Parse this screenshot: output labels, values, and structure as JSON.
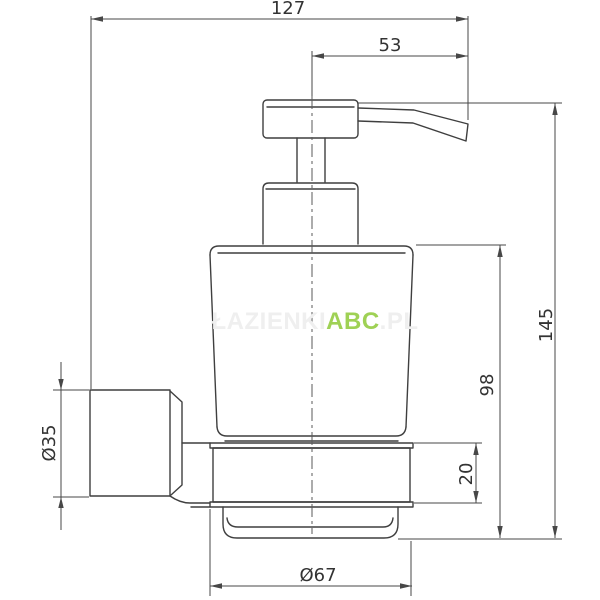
{
  "drawing": {
    "title": "Wall-mounted soap dispenser — dimensional drawing"
  },
  "dimensions": {
    "total_reach": "127",
    "spout_reach": "53",
    "total_height": "145",
    "bottle_height": "98",
    "holder_ring_height": "20",
    "bracket_diameter": "Ø35",
    "holder_ring_diameter": "Ø67"
  },
  "watermark": {
    "prefix": "ŁAZIENKI",
    "brand": "ABC",
    "suffix": ".PL"
  },
  "colors": {
    "outline": "#3f3f3f",
    "dimension": "#474747",
    "text": "#333333",
    "watermark_brand": "#9fd155",
    "watermark_faint": "#efefef",
    "background": "#ffffff"
  }
}
